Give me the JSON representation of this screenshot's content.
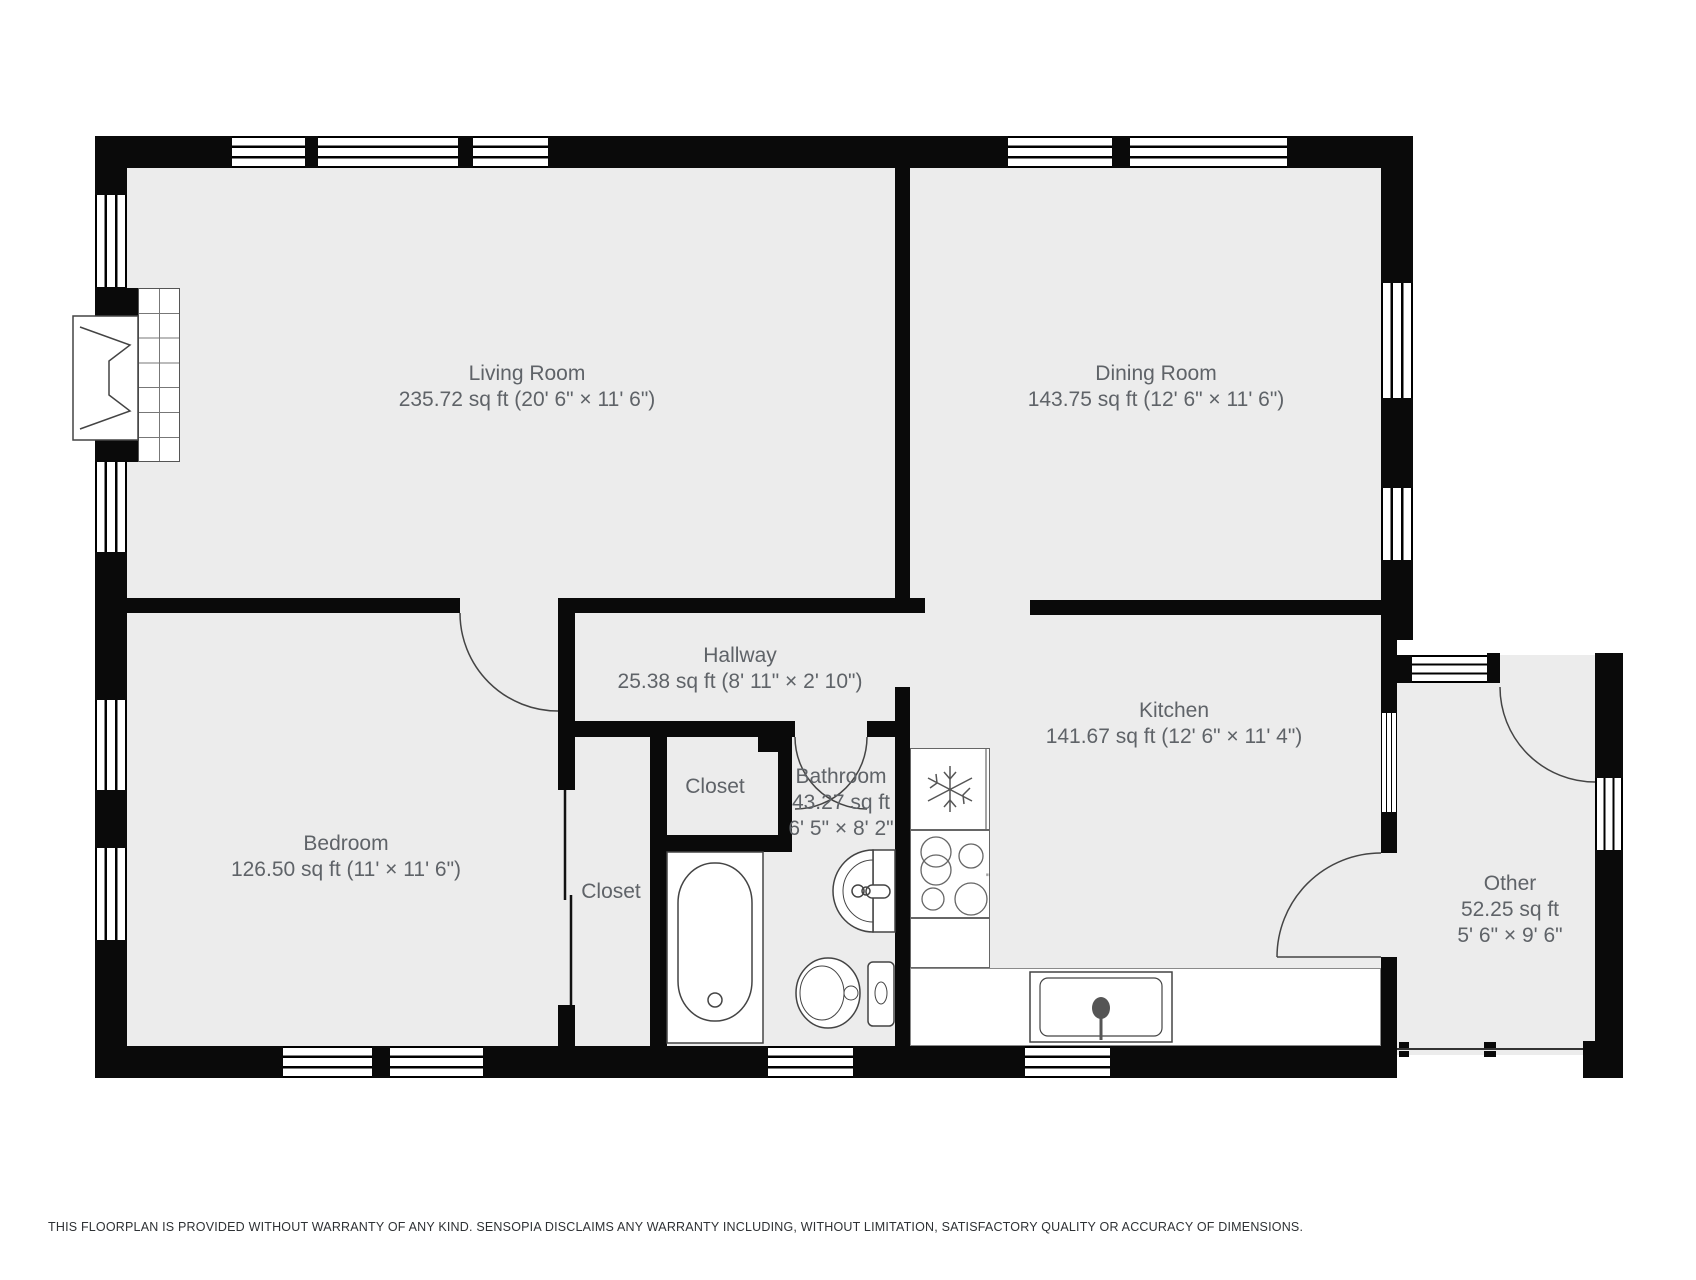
{
  "rooms": {
    "living": {
      "name": "Living Room",
      "size": "235.72 sq ft (20' 6\" × 11' 6\")"
    },
    "dining": {
      "name": "Dining Room",
      "size": "143.75 sq ft (12' 6\" × 11' 6\")"
    },
    "hallway": {
      "name": "Hallway",
      "size": "25.38 sq ft (8' 11\" × 2' 10\")"
    },
    "kitchen": {
      "name": "Kitchen",
      "size": "141.67 sq ft (12' 6\" × 11' 4\")"
    },
    "bedroom": {
      "name": "Bedroom",
      "size": "126.50 sq ft (11' × 11' 6\")"
    },
    "bathroom": {
      "name": "Bathroom",
      "area": "43.27 sq ft",
      "dims": "6' 5\" × 8' 2\""
    },
    "other": {
      "name": "Other",
      "area": "52.25 sq ft",
      "dims": "5' 6\" × 9' 6\""
    },
    "closet_hall": {
      "name": "Closet"
    },
    "closet_bedroom": {
      "name": "Closet"
    }
  },
  "footer": {
    "disclaimer": "THIS FLOORPLAN IS PROVIDED WITHOUT WARRANTY OF ANY KIND. SENSOPIA DISCLAIMS ANY WARRANTY INCLUDING, WITHOUT LIMITATION, SATISFACTORY QUALITY OR ACCURACY OF DIMENSIONS."
  },
  "colors": {
    "wall": "#0a0a0a",
    "floor": "#ececec",
    "label_text": "#5f6368",
    "fixture_stroke": "#555555"
  }
}
